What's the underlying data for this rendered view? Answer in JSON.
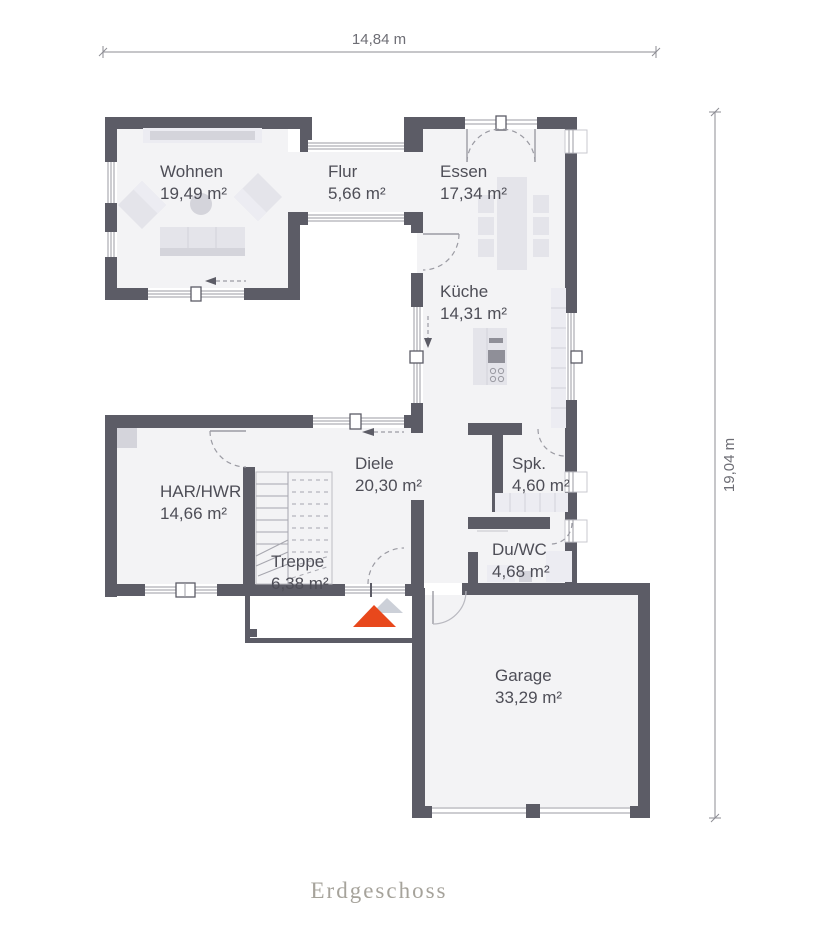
{
  "floor_label": "Erdgeschoss",
  "dimensions": {
    "width": "14,84 m",
    "height": "19,04 m"
  },
  "rooms": [
    {
      "name": "Wohnen",
      "area": "19,49 m²"
    },
    {
      "name": "Flur",
      "area": "5,66 m²"
    },
    {
      "name": "Essen",
      "area": "17,34 m²"
    },
    {
      "name": "Küche",
      "area": "14,31 m²"
    },
    {
      "name": "HAR/HWR",
      "area": "14,66 m²"
    },
    {
      "name": "Diele",
      "area": "20,30 m²"
    },
    {
      "name": "Spk.",
      "area": "4,60 m²"
    },
    {
      "name": "Treppe",
      "area": "6,38 m²"
    },
    {
      "name": "Du/WC",
      "area": "4,68 m²"
    },
    {
      "name": "Garage",
      "area": "33,29 m²"
    }
  ],
  "colors": {
    "wall": "#5c5c66",
    "floor": "#f3f3f5",
    "furn": "#e4e4ea",
    "furn_dark": "#d4d4db",
    "line": "#9b9ba3",
    "text": "#4e4e57",
    "accent_red": "#e8481c",
    "accent_gray": "#ccd0d8"
  }
}
